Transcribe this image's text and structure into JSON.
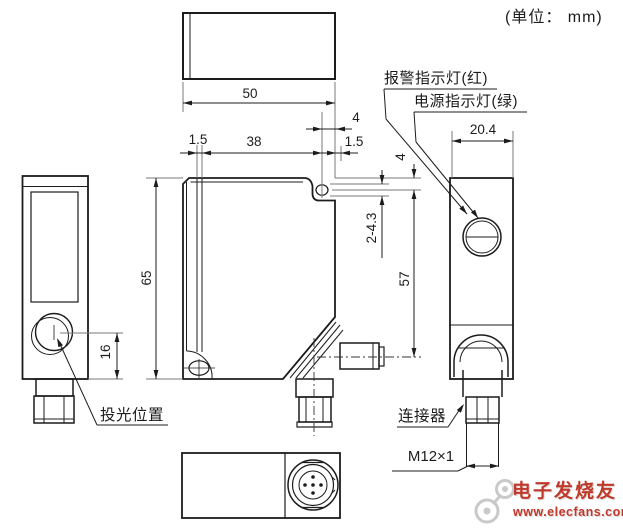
{
  "unit_note": "(单位： mm)",
  "labels": {
    "alarm": "报警指示灯(红)",
    "power": "电源指示灯(绿)",
    "emitter": "投光位置",
    "connector": "连接器"
  },
  "dimensions": {
    "body_width": "50",
    "edge_offset_left": "1.5",
    "window_width": "38",
    "hole_to_edge": "4",
    "edge_offset_right": "1.5",
    "side_width": "20.4",
    "hole_top_offset": "4",
    "mounting_holes": "2-4.3",
    "body_height": "65",
    "hole_to_connector": "57",
    "lens_center_height": "16",
    "thread": "M12×1"
  },
  "watermark": {
    "brand": "电子发烧友",
    "url": "www.elecfans.com"
  },
  "colors": {
    "line": "#1c1c1c",
    "dimension_line": "#7a7a7a",
    "watermark_red": "#c0392b",
    "watermark_gray": "#c9c9c9",
    "background": "#ffffff"
  }
}
